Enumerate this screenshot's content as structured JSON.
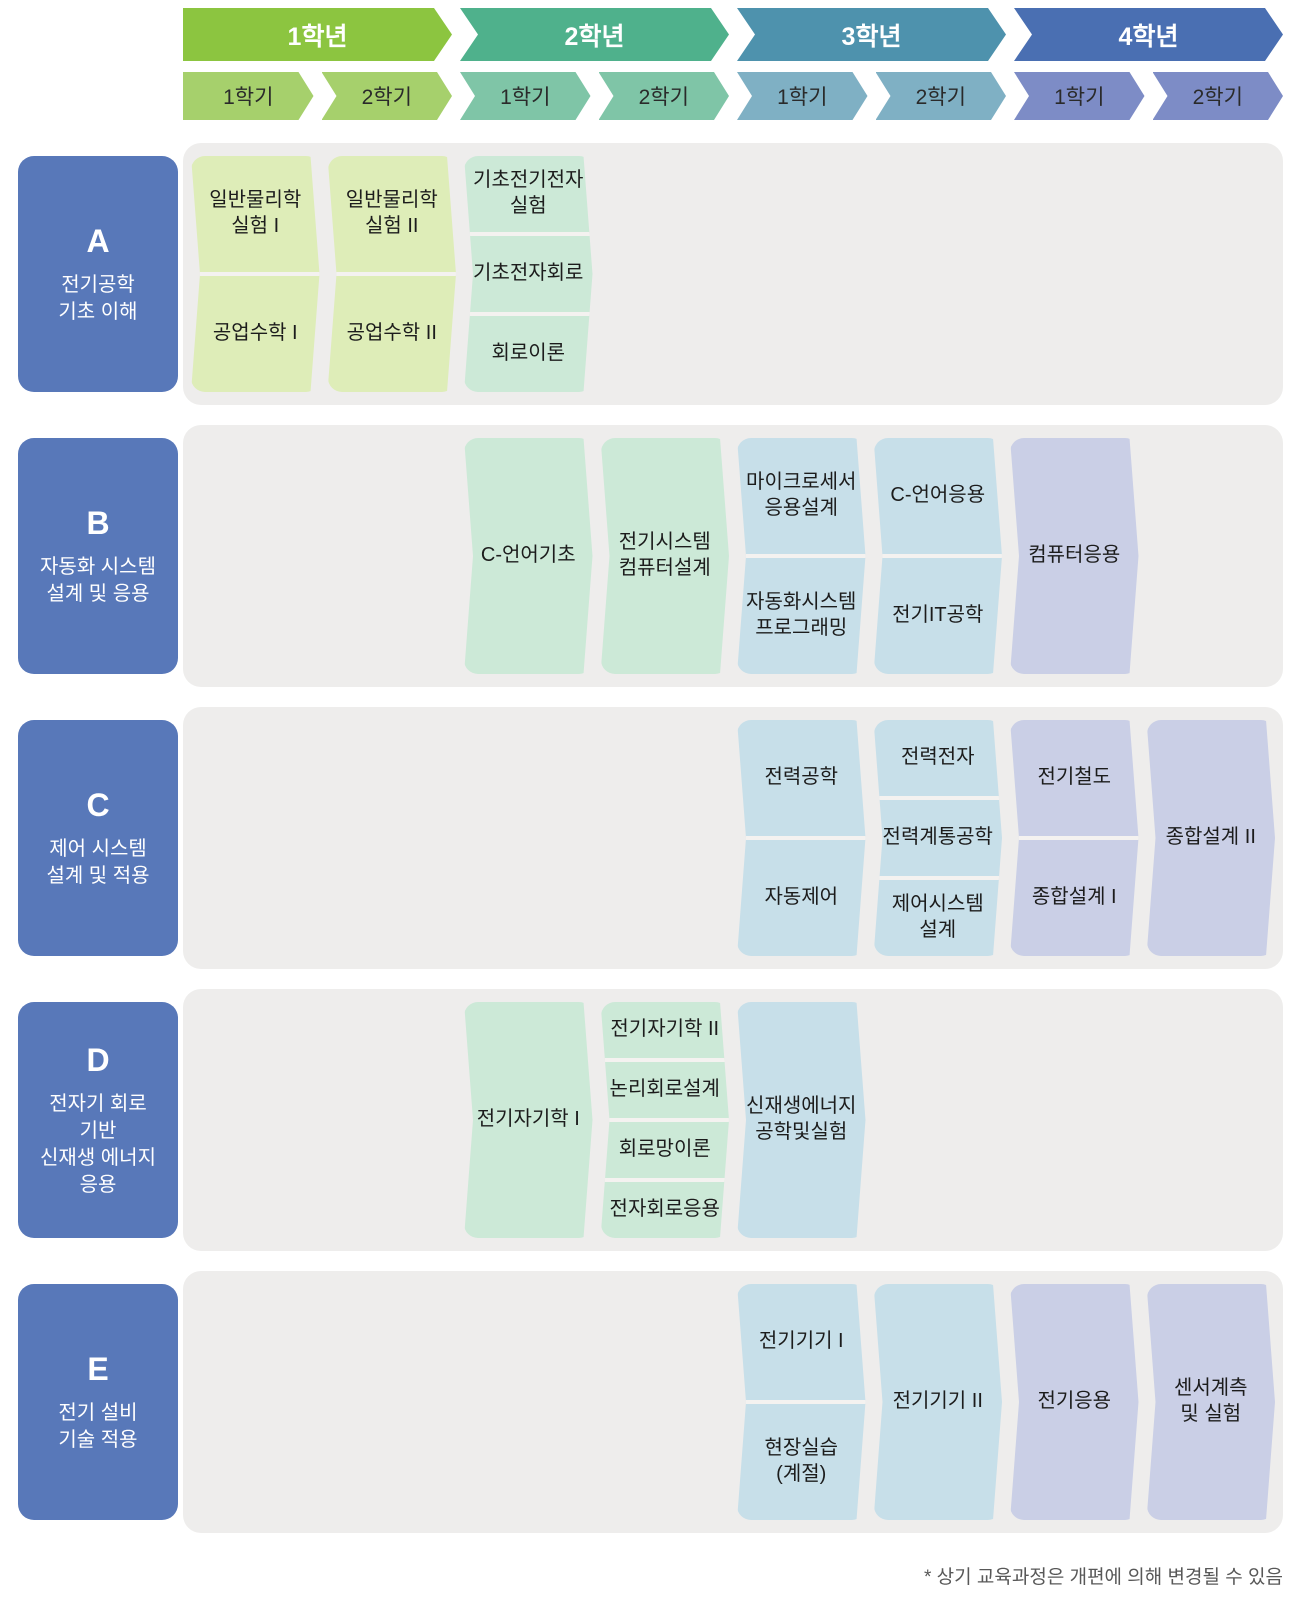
{
  "header": {
    "years": [
      {
        "label": "1학년"
      },
      {
        "label": "2학년"
      },
      {
        "label": "3학년"
      },
      {
        "label": "4학년"
      }
    ],
    "semesters": [
      "1학기",
      "2학기",
      "1학기",
      "2학기",
      "1학기",
      "2학기",
      "1학기",
      "2학기"
    ]
  },
  "colors": {
    "year_fills": [
      "#8cc540",
      "#4fb18c",
      "#4e92ad",
      "#4a6fb2"
    ],
    "semester_fills": [
      "#a6d06c",
      "#7fc5a7",
      "#7fb0c4",
      "#7d8cc6"
    ],
    "card_fills": [
      "#deedb8",
      "#cce9d7",
      "#c7dfe9",
      "#cacfe6"
    ],
    "row_label_fill": "#5878b9",
    "band_fill": "#eeedec",
    "card_text": "#1c1c1c",
    "divider": "#f4f2f0"
  },
  "rows": [
    {
      "letter": "A",
      "title": "전기공학\n기초 이해",
      "cells": [
        {
          "col": 0,
          "courses": [
            "일반물리학\n실험 I",
            "공업수학 I"
          ]
        },
        {
          "col": 1,
          "courses": [
            "일반물리학\n실험 II",
            "공업수학 II"
          ]
        },
        {
          "col": 2,
          "courses": [
            "기초전기전자\n실험",
            "기초전자회로",
            "회로이론"
          ]
        }
      ]
    },
    {
      "letter": "B",
      "title": "자동화 시스템\n설계 및 응용",
      "cells": [
        {
          "col": 2,
          "courses": [
            "C-언어기초"
          ]
        },
        {
          "col": 3,
          "courses": [
            "전기시스템\n컴퓨터설계"
          ]
        },
        {
          "col": 4,
          "courses": [
            "마이크로세서\n응용설계",
            "자동화시스템\n프로그래밍"
          ]
        },
        {
          "col": 5,
          "courses": [
            "C-언어응용",
            "전기IT공학"
          ]
        },
        {
          "col": 6,
          "courses": [
            "컴퓨터응용"
          ]
        }
      ]
    },
    {
      "letter": "C",
      "title": "제어 시스템\n설계 및 적용",
      "cells": [
        {
          "col": 4,
          "courses": [
            "전력공학",
            "자동제어"
          ]
        },
        {
          "col": 5,
          "courses": [
            "전력전자",
            "전력계통공학",
            "제어시스템\n설계"
          ]
        },
        {
          "col": 6,
          "courses": [
            "전기철도",
            "종합설계 I"
          ]
        },
        {
          "col": 7,
          "courses": [
            "종합설계 II"
          ]
        }
      ]
    },
    {
      "letter": "D",
      "title": "전자기 회로\n기반\n신재생 에너지\n응용",
      "cells": [
        {
          "col": 2,
          "courses": [
            "전기자기학 I"
          ]
        },
        {
          "col": 3,
          "courses": [
            "전기자기학 II",
            "논리회로설계",
            "회로망이론",
            "전자회로응용"
          ]
        },
        {
          "col": 4,
          "courses": [
            "신재생에너지\n공학및실험"
          ]
        }
      ]
    },
    {
      "letter": "E",
      "title": "전기 설비\n기술 적용",
      "cells": [
        {
          "col": 4,
          "courses": [
            "전기기기 I",
            "현장실습\n(계절)"
          ]
        },
        {
          "col": 5,
          "courses": [
            "전기기기 II"
          ]
        },
        {
          "col": 6,
          "courses": [
            "전기응용"
          ]
        },
        {
          "col": 7,
          "courses": [
            "센서계측\n및 실험"
          ]
        }
      ]
    }
  ],
  "footnote": "* 상기 교육과정은 개편에 의해 변경될 수 있음"
}
